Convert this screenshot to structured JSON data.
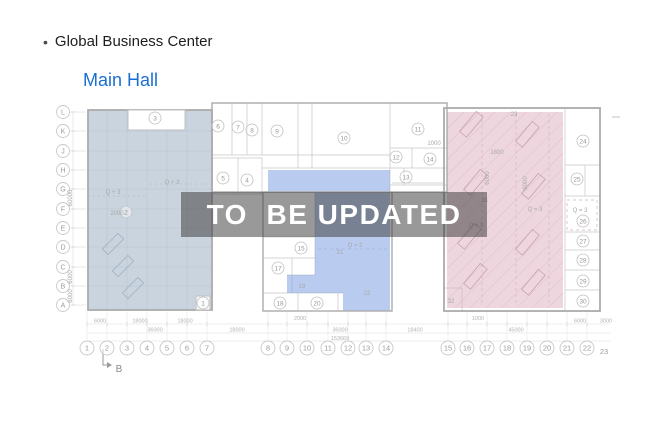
{
  "header": {
    "bullet": "•",
    "title": "Global Business Center"
  },
  "nav": {
    "hall_link": "Main Hall"
  },
  "watermark": {
    "text": "TO  BE UPDATED"
  },
  "plan": {
    "colors": {
      "left_fill": "#9fb0c2",
      "mid_fill": "#7fa3e2",
      "right_fill": "#ddadc0",
      "hatch_line": "#cfa3b3",
      "accent_blue": "#1b6fd4"
    },
    "row_axis": [
      {
        "l": "L",
        "y": 112
      },
      {
        "l": "K",
        "y": 131
      },
      {
        "l": "J",
        "y": 151
      },
      {
        "l": "H",
        "y": 170
      },
      {
        "l": "G",
        "y": 189
      },
      {
        "l": "F",
        "y": 209
      },
      {
        "l": "E",
        "y": 228
      },
      {
        "l": "D",
        "y": 247
      },
      {
        "l": "C",
        "y": 267
      },
      {
        "l": "B",
        "y": 286
      },
      {
        "l": "A",
        "y": 305
      }
    ],
    "col_axis": [
      {
        "l": "1",
        "x": 87
      },
      {
        "l": "2",
        "x": 107
      },
      {
        "l": "3",
        "x": 127
      },
      {
        "l": "4",
        "x": 147
      },
      {
        "l": "5",
        "x": 167
      },
      {
        "l": "6",
        "x": 187
      },
      {
        "l": "7",
        "x": 207
      },
      {
        "l": "8",
        "x": 268
      },
      {
        "l": "9",
        "x": 287
      },
      {
        "l": "10",
        "x": 307
      },
      {
        "l": "11",
        "x": 328
      },
      {
        "l": "12",
        "x": 348
      },
      {
        "l": "13",
        "x": 366
      },
      {
        "l": "14",
        "x": 386
      },
      {
        "l": "15",
        "x": 448
      },
      {
        "l": "16",
        "x": 467
      },
      {
        "l": "17",
        "x": 487
      },
      {
        "l": "18",
        "x": 507
      },
      {
        "l": "19",
        "x": 527
      },
      {
        "l": "20",
        "x": 547
      },
      {
        "l": "21",
        "x": 567
      },
      {
        "l": "22",
        "x": 587
      },
      {
        "l": "23",
        "x": 604,
        "plain": true,
        "y": 352
      }
    ],
    "rooms": [
      {
        "n": "1",
        "x": 203,
        "y": 303
      },
      {
        "n": "2",
        "x": 126,
        "y": 212
      },
      {
        "n": "3",
        "x": 155,
        "y": 118
      },
      {
        "n": "4",
        "x": 247,
        "y": 180
      },
      {
        "n": "5",
        "x": 223,
        "y": 178
      },
      {
        "n": "6",
        "x": 218,
        "y": 126
      },
      {
        "n": "7",
        "x": 238,
        "y": 127
      },
      {
        "n": "8",
        "x": 252,
        "y": 130
      },
      {
        "n": "9",
        "x": 277,
        "y": 131
      },
      {
        "n": "10",
        "x": 344,
        "y": 138
      },
      {
        "n": "11",
        "x": 418,
        "y": 129
      },
      {
        "n": "12",
        "x": 396,
        "y": 157
      },
      {
        "n": "13",
        "x": 406,
        "y": 177
      },
      {
        "n": "14",
        "x": 430,
        "y": 159
      },
      {
        "n": "15",
        "x": 301,
        "y": 248
      },
      {
        "n": "17",
        "x": 278,
        "y": 268
      },
      {
        "n": "18",
        "x": 280,
        "y": 303
      },
      {
        "n": "20",
        "x": 317,
        "y": 303
      },
      {
        "n": "24",
        "x": 583,
        "y": 141
      },
      {
        "n": "25",
        "x": 577,
        "y": 179
      },
      {
        "n": "26",
        "x": 583,
        "y": 221
      },
      {
        "n": "27",
        "x": 583,
        "y": 241
      },
      {
        "n": "28",
        "x": 583,
        "y": 260
      },
      {
        "n": "29",
        "x": 583,
        "y": 281
      },
      {
        "n": "30",
        "x": 583,
        "y": 301
      }
    ],
    "labels": [
      {
        "t": "19",
        "x": 302,
        "y": 286
      },
      {
        "t": "21",
        "x": 340,
        "y": 252
      },
      {
        "t": "22",
        "x": 367,
        "y": 293
      },
      {
        "t": "23",
        "x": 514,
        "y": 114
      },
      {
        "t": "31",
        "x": 485,
        "y": 200
      },
      {
        "t": "32",
        "x": 451,
        "y": 301
      },
      {
        "t": "Q + 3",
        "x": 172,
        "y": 182
      },
      {
        "t": "Q + 3",
        "x": 113,
        "y": 192
      },
      {
        "t": "2000",
        "x": 117,
        "y": 213
      },
      {
        "t": "Q = 2",
        "x": 355,
        "y": 245
      },
      {
        "t": "Q = 3",
        "x": 535,
        "y": 209
      },
      {
        "t": "Q = 3",
        "x": 476,
        "y": 225
      },
      {
        "t": "Q = 3",
        "x": 580,
        "y": 210
      },
      {
        "t": "1800",
        "x": 497,
        "y": 152
      },
      {
        "t": "1000",
        "x": 434,
        "y": 143
      },
      {
        "t": "60000",
        "x": 70,
        "y": 198,
        "rot": true
      },
      {
        "t": "6000",
        "x": 70,
        "y": 277,
        "rot": true
      },
      {
        "t": "6000",
        "x": 70,
        "y": 296,
        "rot": true
      },
      {
        "t": "6000",
        "x": 487,
        "y": 178,
        "rot": true
      },
      {
        "t": "6000",
        "x": 525,
        "y": 183,
        "rot": true
      },
      {
        "t": "B",
        "x": 119,
        "y": 370,
        "s": 10,
        "c": "#8a8a8a"
      }
    ],
    "dims": [
      {
        "t": "6000",
        "x": 100,
        "y": 320.5
      },
      {
        "t": "18000",
        "x": 140,
        "y": 320.5
      },
      {
        "t": "18000",
        "x": 185,
        "y": 320.5
      },
      {
        "t": "2000",
        "x": 300,
        "y": 318
      },
      {
        "t": "1000",
        "x": 478,
        "y": 318
      },
      {
        "t": "6000",
        "x": 580,
        "y": 320.5
      },
      {
        "t": "3000",
        "x": 606,
        "y": 320.5
      },
      {
        "t": "36000",
        "x": 155,
        "y": 329.5
      },
      {
        "t": "18000",
        "x": 237,
        "y": 329.5
      },
      {
        "t": "36000",
        "x": 340,
        "y": 329.5
      },
      {
        "t": "18400",
        "x": 415,
        "y": 329.5
      },
      {
        "t": "45000",
        "x": 516,
        "y": 329.5
      },
      {
        "t": "153669",
        "x": 340,
        "y": 338
      }
    ]
  }
}
